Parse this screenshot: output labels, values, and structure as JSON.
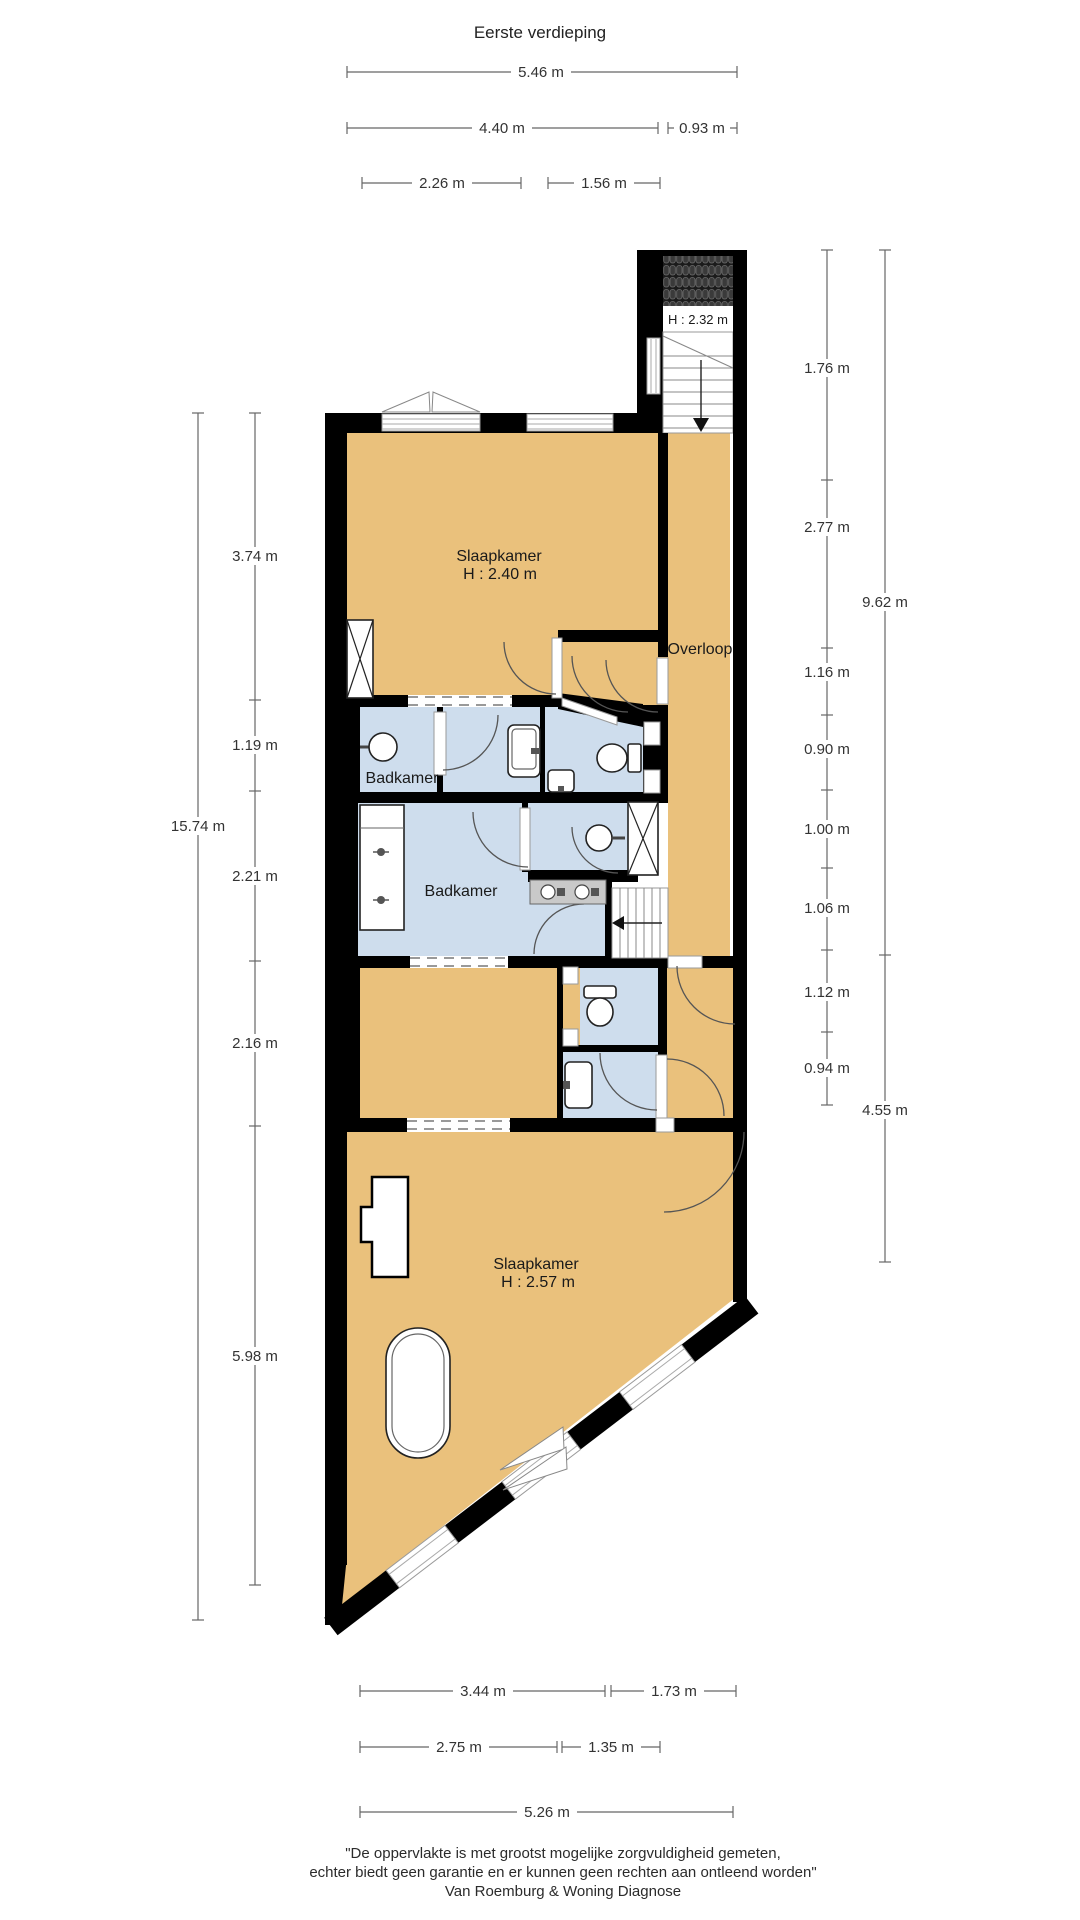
{
  "title": "Eerste verdieping",
  "plan": {
    "rooms": [
      {
        "id": "bedroom-top",
        "label": "Slaapkamer",
        "height": "H : 2.40 m"
      },
      {
        "id": "landing",
        "label": "Overloop",
        "height": ""
      },
      {
        "id": "bathroom-small",
        "label": "Badkamer",
        "height": ""
      },
      {
        "id": "bathroom-large",
        "label": "Badkamer",
        "height": ""
      },
      {
        "id": "bedroom-bottom",
        "label": "Slaapkamer",
        "height": "H : 2.57 m"
      }
    ],
    "stairwell_height": "H : 2.32 m"
  },
  "dimensions": {
    "top": [
      "5.46 m",
      "4.40 m",
      "0.93 m",
      "2.26 m",
      "1.56 m"
    ],
    "left_total": "15.74 m",
    "left": [
      "3.74 m",
      "1.19 m",
      "2.21 m",
      "2.16 m",
      "5.98 m"
    ],
    "right": [
      "1.76 m",
      "2.77 m",
      "1.16 m",
      "0.90 m",
      "1.00 m",
      "1.06 m",
      "1.12 m",
      "0.94 m"
    ],
    "right_outer": [
      "9.62 m",
      "4.55 m"
    ],
    "bottom": [
      "3.44 m",
      "1.73 m",
      "2.75 m",
      "1.35 m",
      "5.26 m"
    ]
  },
  "footer": {
    "line1": "\"De oppervlakte is met grootst mogelijke zorgvuldigheid gemeten,",
    "line2": "echter biedt geen garantie en er kunnen geen rechten aan ontleend worden\"",
    "line3": "Van Roemburg & Woning Diagnose"
  },
  "colors": {
    "wall": "#000000",
    "room_orange": "#eac17c",
    "room_blue": "#cedded",
    "frame_gray": "#9a9a9a",
    "dim_line": "#666666",
    "counter_gray": "#c9c9c9"
  }
}
